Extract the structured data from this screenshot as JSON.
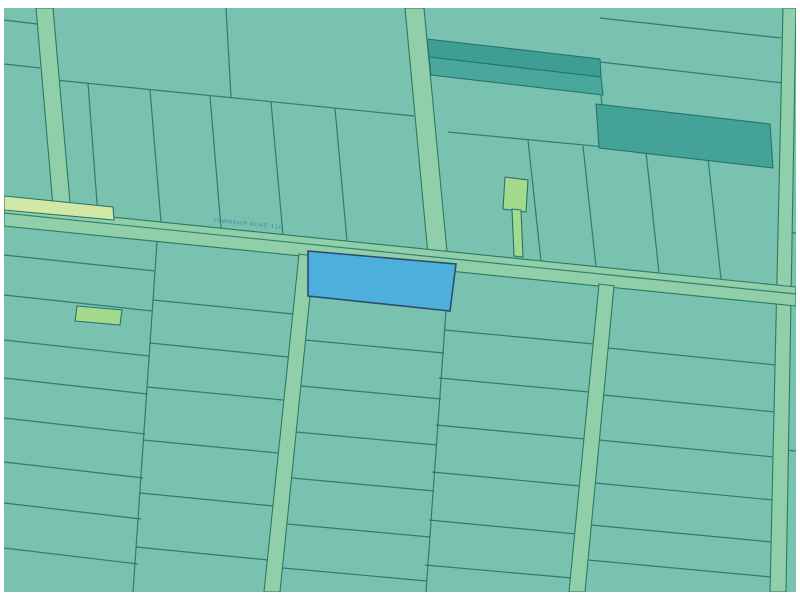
{
  "app": {
    "type": "gis-parcel-map-viewport",
    "title": "Parcel map"
  },
  "map": {
    "canvas": {
      "width": 800,
      "height": 600,
      "frame_color": "#ffffff",
      "frame": {
        "left": 4,
        "top": 8,
        "right": 796,
        "bottom": 592
      }
    },
    "palette": {
      "base_parcel": "#7ac2b0",
      "lot_line": "#27736b",
      "road_fill": "#90cfaa",
      "road_edge": "#2a7a60",
      "dark_parcel_a": "#3f9e93",
      "dark_parcel_b": "#4aa79b",
      "dark_parcel_c": "#44a298",
      "light_green_parcel": "#a3da8e",
      "pale_green_strip": "#d2e8a6",
      "selected_fill": "#4db0dc",
      "selected_stroke": "#2c4d6e",
      "label_color": "#2f6f8f"
    },
    "road_label": {
      "text": "TOWNSHIP ROAD 110",
      "color": "#2f6f8f"
    },
    "selected_parcel": {
      "fill": "#4db0dc",
      "stroke": "#2c4d6e"
    },
    "features": [
      {
        "name": "map-base",
        "kind": "polygon",
        "interactable": true,
        "points": [
          [
            4,
            8
          ],
          [
            796,
            8
          ],
          [
            796,
            592
          ],
          [
            4,
            592
          ]
        ],
        "fill": "#7ac2b0"
      },
      {
        "name": "lot-line",
        "kind": "line",
        "points": [
          4,
          20,
          37,
          24
        ]
      },
      {
        "name": "lot-line",
        "kind": "line",
        "points": [
          4,
          64,
          40,
          68
        ]
      },
      {
        "name": "lot-line",
        "kind": "line",
        "points": [
          55,
          80,
          414,
          116
        ]
      },
      {
        "name": "lot-line",
        "kind": "line",
        "points": [
          226,
          8,
          231,
          97
        ]
      },
      {
        "name": "lot-line",
        "kind": "line",
        "points": [
          88,
          83,
          98,
          216
        ]
      },
      {
        "name": "lot-line",
        "kind": "line",
        "points": [
          150,
          90,
          161,
          222
        ]
      },
      {
        "name": "lot-line",
        "kind": "line",
        "points": [
          210,
          96,
          221,
          228
        ]
      },
      {
        "name": "lot-line",
        "kind": "line",
        "points": [
          271,
          102,
          283,
          235
        ]
      },
      {
        "name": "lot-line",
        "kind": "line",
        "points": [
          335,
          108,
          347,
          241
        ]
      },
      {
        "name": "lot-line",
        "kind": "line",
        "points": [
          448,
          132,
          773,
          163
        ]
      },
      {
        "name": "lot-line",
        "kind": "line",
        "points": [
          528,
          140,
          541,
          261
        ]
      },
      {
        "name": "lot-line",
        "kind": "line",
        "points": [
          583,
          146,
          596,
          267
        ]
      },
      {
        "name": "lot-line",
        "kind": "line",
        "points": [
          646,
          152,
          659,
          273
        ]
      },
      {
        "name": "lot-line",
        "kind": "line",
        "points": [
          708,
          158,
          721,
          279
        ]
      },
      {
        "name": "lot-line",
        "kind": "line",
        "points": [
          600,
          18,
          781,
          38
        ]
      },
      {
        "name": "lot-line",
        "kind": "line",
        "points": [
          600,
          62,
          783,
          83
        ]
      },
      {
        "name": "lot-line",
        "kind": "line",
        "points": [
          597,
          59,
          602,
          105
        ]
      },
      {
        "name": "lot-line",
        "kind": "line",
        "points": [
          157,
          242,
          133,
          592
        ]
      },
      {
        "name": "lot-line",
        "kind": "line",
        "points": [
          4,
          255,
          155,
          271
        ]
      },
      {
        "name": "lot-line",
        "kind": "line",
        "points": [
          4,
          295,
          152,
          311
        ]
      },
      {
        "name": "lot-line",
        "kind": "line",
        "points": [
          4,
          340,
          149,
          356
        ]
      },
      {
        "name": "lot-line",
        "kind": "line",
        "points": [
          4,
          378,
          147,
          394
        ]
      },
      {
        "name": "lot-line",
        "kind": "line",
        "points": [
          4,
          418,
          145,
          434
        ]
      },
      {
        "name": "lot-line",
        "kind": "line",
        "points": [
          4,
          462,
          143,
          478
        ]
      },
      {
        "name": "lot-line",
        "kind": "line",
        "points": [
          4,
          503,
          141,
          519
        ]
      },
      {
        "name": "lot-line",
        "kind": "line",
        "points": [
          4,
          548,
          138,
          564
        ]
      },
      {
        "name": "lot-line",
        "kind": "line",
        "points": [
          153,
          300,
          293,
          314
        ]
      },
      {
        "name": "lot-line",
        "kind": "line",
        "points": [
          150,
          343,
          288,
          357
        ]
      },
      {
        "name": "lot-line",
        "kind": "line",
        "points": [
          147,
          387,
          283,
          400
        ]
      },
      {
        "name": "lot-line",
        "kind": "line",
        "points": [
          143,
          440,
          278,
          453
        ]
      },
      {
        "name": "lot-line",
        "kind": "line",
        "points": [
          140,
          493,
          273,
          506
        ]
      },
      {
        "name": "lot-line",
        "kind": "line",
        "points": [
          136,
          547,
          268,
          560
        ]
      },
      {
        "name": "lot-line",
        "kind": "line",
        "points": [
          449,
          268,
          426,
          592
        ]
      },
      {
        "name": "lot-line",
        "kind": "line",
        "points": [
          305,
          340,
          444,
          353
        ]
      },
      {
        "name": "lot-line",
        "kind": "line",
        "points": [
          301,
          386,
          441,
          399
        ]
      },
      {
        "name": "lot-line",
        "kind": "line",
        "points": [
          296,
          432,
          437,
          445
        ]
      },
      {
        "name": "lot-line",
        "kind": "line",
        "points": [
          292,
          478,
          434,
          491
        ]
      },
      {
        "name": "lot-line",
        "kind": "line",
        "points": [
          287,
          524,
          430,
          537
        ]
      },
      {
        "name": "lot-line",
        "kind": "line",
        "points": [
          283,
          568,
          427,
          581
        ]
      },
      {
        "name": "lot-line",
        "kind": "line",
        "points": [
          444,
          330,
          594,
          344
        ]
      },
      {
        "name": "lot-line",
        "kind": "line",
        "points": [
          439,
          378,
          589,
          392
        ]
      },
      {
        "name": "lot-line",
        "kind": "line",
        "points": [
          436,
          425,
          585,
          439
        ]
      },
      {
        "name": "lot-line",
        "kind": "line",
        "points": [
          432,
          472,
          580,
          486
        ]
      },
      {
        "name": "lot-line",
        "kind": "line",
        "points": [
          429,
          520,
          576,
          534
        ]
      },
      {
        "name": "lot-line",
        "kind": "line",
        "points": [
          425,
          565,
          572,
          578
        ]
      },
      {
        "name": "lot-line",
        "kind": "line",
        "points": [
          608,
          348,
          776,
          365
        ]
      },
      {
        "name": "lot-line",
        "kind": "line",
        "points": [
          603,
          395,
          775,
          412
        ]
      },
      {
        "name": "lot-line",
        "kind": "line",
        "points": [
          599,
          440,
          774,
          457
        ]
      },
      {
        "name": "lot-line",
        "kind": "line",
        "points": [
          595,
          483,
          773,
          500
        ]
      },
      {
        "name": "lot-line",
        "kind": "line",
        "points": [
          591,
          525,
          772,
          542
        ]
      },
      {
        "name": "lot-line",
        "kind": "line",
        "points": [
          588,
          560,
          771,
          577
        ]
      },
      {
        "name": "lot-line",
        "kind": "line",
        "points": [
          786,
          232,
          796,
          233
        ]
      },
      {
        "name": "lot-line",
        "kind": "line",
        "points": [
          783,
          450,
          796,
          451
        ]
      },
      {
        "name": "road-vertical-left",
        "kind": "band",
        "interactable": false,
        "points": [
          [
            36,
            8
          ],
          [
            53,
            8
          ],
          [
            71,
            214
          ],
          [
            54,
            218
          ]
        ]
      },
      {
        "name": "road-vertical-mid",
        "kind": "band",
        "interactable": false,
        "points": [
          [
            405,
            8
          ],
          [
            424,
            8
          ],
          [
            447,
            252
          ],
          [
            428,
            255
          ]
        ]
      },
      {
        "name": "road-vertical-right",
        "kind": "band",
        "interactable": false,
        "points": [
          [
            783,
            8
          ],
          [
            796,
            8
          ],
          [
            786,
            592
          ],
          [
            770,
            592
          ]
        ]
      },
      {
        "name": "road-main-diagonal",
        "kind": "band",
        "interactable": false,
        "points": [
          [
            4,
            206
          ],
          [
            796,
            287
          ],
          [
            796,
            306
          ],
          [
            4,
            226
          ]
        ]
      },
      {
        "name": "road-centerline",
        "kind": "line",
        "points": [
          4,
          213,
          796,
          294
        ],
        "stroke": "#2a7a60"
      },
      {
        "name": "road-vertical-below-a",
        "kind": "band",
        "interactable": false,
        "points": [
          [
            299,
            254
          ],
          [
            314,
            256
          ],
          [
            280,
            592
          ],
          [
            264,
            592
          ]
        ]
      },
      {
        "name": "road-vertical-below-b",
        "kind": "band",
        "interactable": false,
        "points": [
          [
            599,
            284
          ],
          [
            614,
            286
          ],
          [
            585,
            592
          ],
          [
            569,
            592
          ]
        ]
      },
      {
        "name": "parcel-dark-strip-1",
        "kind": "polygon",
        "interactable": true,
        "points": [
          [
            427,
            39
          ],
          [
            600,
            59
          ],
          [
            601,
            77
          ],
          [
            429,
            57
          ]
        ],
        "fill": "#3f9e93",
        "stroke": "#27736b"
      },
      {
        "name": "parcel-dark-strip-2",
        "kind": "polygon",
        "interactable": true,
        "points": [
          [
            429,
            57
          ],
          [
            601,
            77
          ],
          [
            603,
            95
          ],
          [
            431,
            75
          ]
        ],
        "fill": "#4aa79b",
        "stroke": "#27736b"
      },
      {
        "name": "parcel-dark-rect-right",
        "kind": "polygon",
        "interactable": true,
        "points": [
          [
            596,
            104
          ],
          [
            770,
            124
          ],
          [
            773,
            168
          ],
          [
            599,
            148
          ]
        ],
        "fill": "#44a298",
        "stroke": "#27736b"
      },
      {
        "name": "parcel-pale-strip-left",
        "kind": "polygon",
        "interactable": true,
        "points": [
          [
            4,
            196
          ],
          [
            113,
            207
          ],
          [
            114,
            220
          ],
          [
            4,
            210
          ]
        ],
        "fill": "#d2e8a6",
        "stroke": "#27736b"
      },
      {
        "name": "parcel-flag-body",
        "kind": "polygon",
        "interactable": true,
        "points": [
          [
            505,
            177
          ],
          [
            528,
            180
          ],
          [
            526,
            212
          ],
          [
            503,
            209
          ]
        ],
        "fill": "#a3da8e",
        "stroke": "#27736b"
      },
      {
        "name": "parcel-flag-stem",
        "kind": "polygon",
        "interactable": true,
        "points": [
          [
            512,
            209
          ],
          [
            521,
            210
          ],
          [
            523,
            257
          ],
          [
            514,
            256
          ]
        ],
        "fill": "#a3da8e",
        "stroke": "#27736b"
      },
      {
        "name": "parcel-light-green-small",
        "kind": "polygon",
        "interactable": true,
        "points": [
          [
            77,
            306
          ],
          [
            122,
            310
          ],
          [
            120,
            325
          ],
          [
            75,
            321
          ]
        ],
        "fill": "#a3da8e",
        "stroke": "#27736b"
      },
      {
        "name": "selected-parcel",
        "kind": "polygon",
        "interactable": true,
        "points": [
          [
            308,
            251
          ],
          [
            456,
            264
          ],
          [
            450,
            311
          ],
          [
            308,
            296
          ]
        ],
        "fill": "#4db0dc",
        "stroke": "#2c4d6e",
        "sw": 1.6
      }
    ]
  }
}
